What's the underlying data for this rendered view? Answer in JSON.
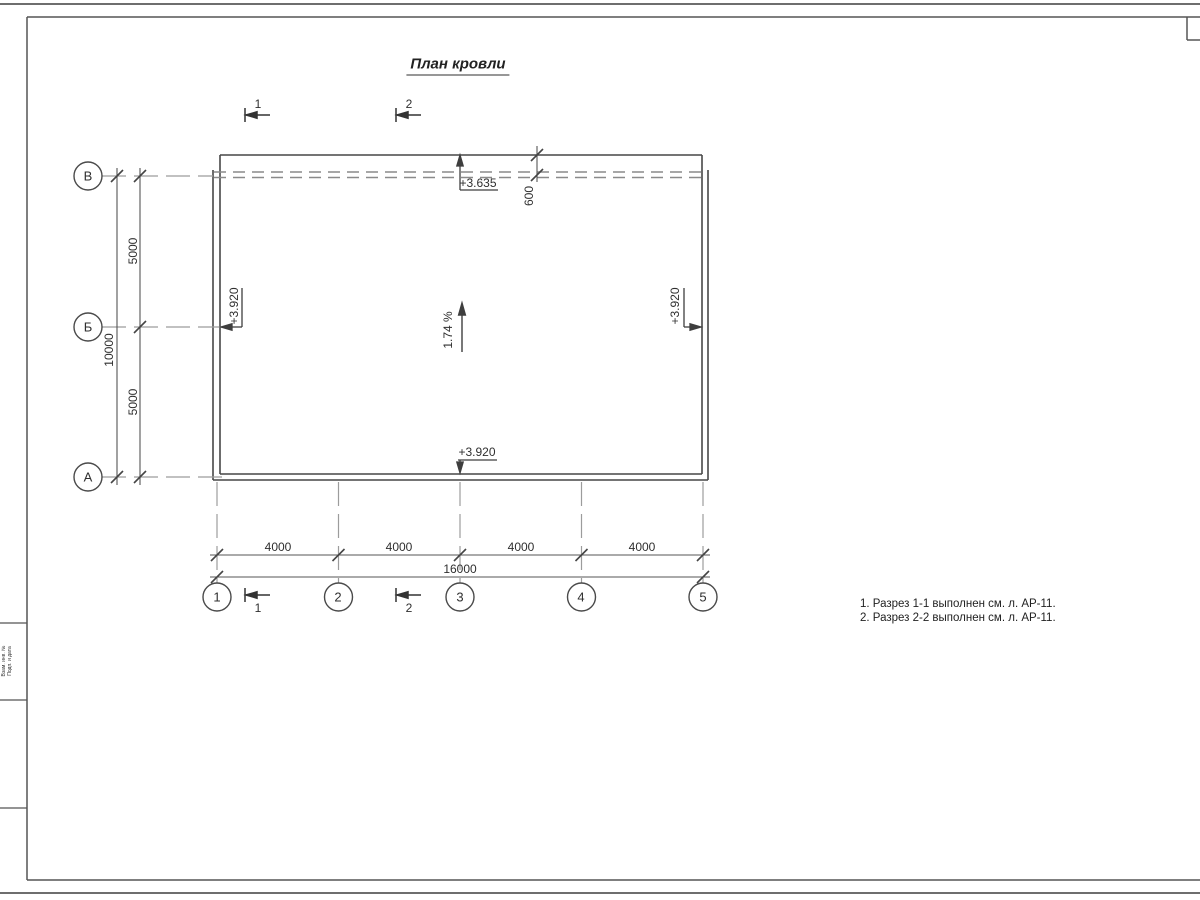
{
  "sheet": {
    "title": "План кровли",
    "notes": [
      "1. Разрез 1-1 выполнен см. л. АР-11.",
      "2. Разрез 2-2 выполнен см. л. АР-11."
    ],
    "margin_labels": [
      "Взам. инв. №",
      "Подп. и дата"
    ]
  },
  "axes": {
    "rows": [
      "В",
      "Б",
      "А"
    ],
    "cols": [
      "1",
      "2",
      "3",
      "4",
      "5"
    ]
  },
  "dimensions": {
    "col_spans": [
      "4000",
      "4000",
      "4000",
      "4000"
    ],
    "col_total": "16000",
    "row_spans": [
      "5000",
      "5000"
    ],
    "row_total": "10000",
    "eave": "600"
  },
  "elevations": {
    "top": "+3.635",
    "left": "+3.920",
    "right": "+3.920",
    "bottom": "+3.920"
  },
  "slope": "1.74 %",
  "sections": {
    "top": [
      "1",
      "2"
    ],
    "bottom": [
      "1",
      "2"
    ]
  },
  "colors": {
    "line_main": "#474747",
    "line_hidden": "#8a8a8a",
    "line_axis": "#9c9c9c",
    "line_dim": "#555555",
    "frame": "#666666"
  }
}
